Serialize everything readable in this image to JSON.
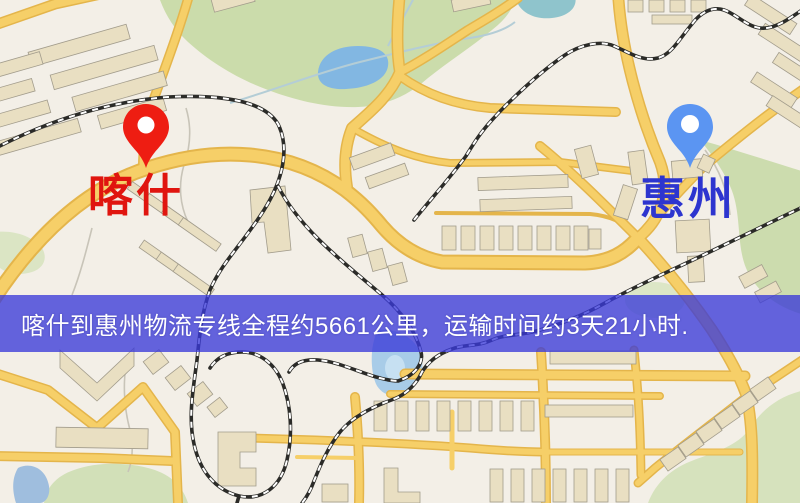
{
  "map": {
    "origin": {
      "label": "喀什",
      "pin_color": "#ee1d12",
      "label_color": "#e0150f"
    },
    "destination": {
      "label": "惠州",
      "pin_color": "#5b95f2",
      "label_color": "#2d35cf"
    },
    "colors": {
      "background": "#f3efe7",
      "road": "#f6cf68",
      "park": "#cbdcab",
      "water": "#82b7e2",
      "building": "#e9dfc2",
      "railway": "#2b2b28"
    }
  },
  "banner": {
    "text": "喀什到惠州物流专线全程约5661公里，运输时间约3天21小时.",
    "background_color": "#3a3ad8",
    "text_color": "#ffffff"
  },
  "route_summary": {
    "from": "喀什",
    "to": "惠州",
    "distance_km": "5661",
    "duration": "3天21小时"
  }
}
